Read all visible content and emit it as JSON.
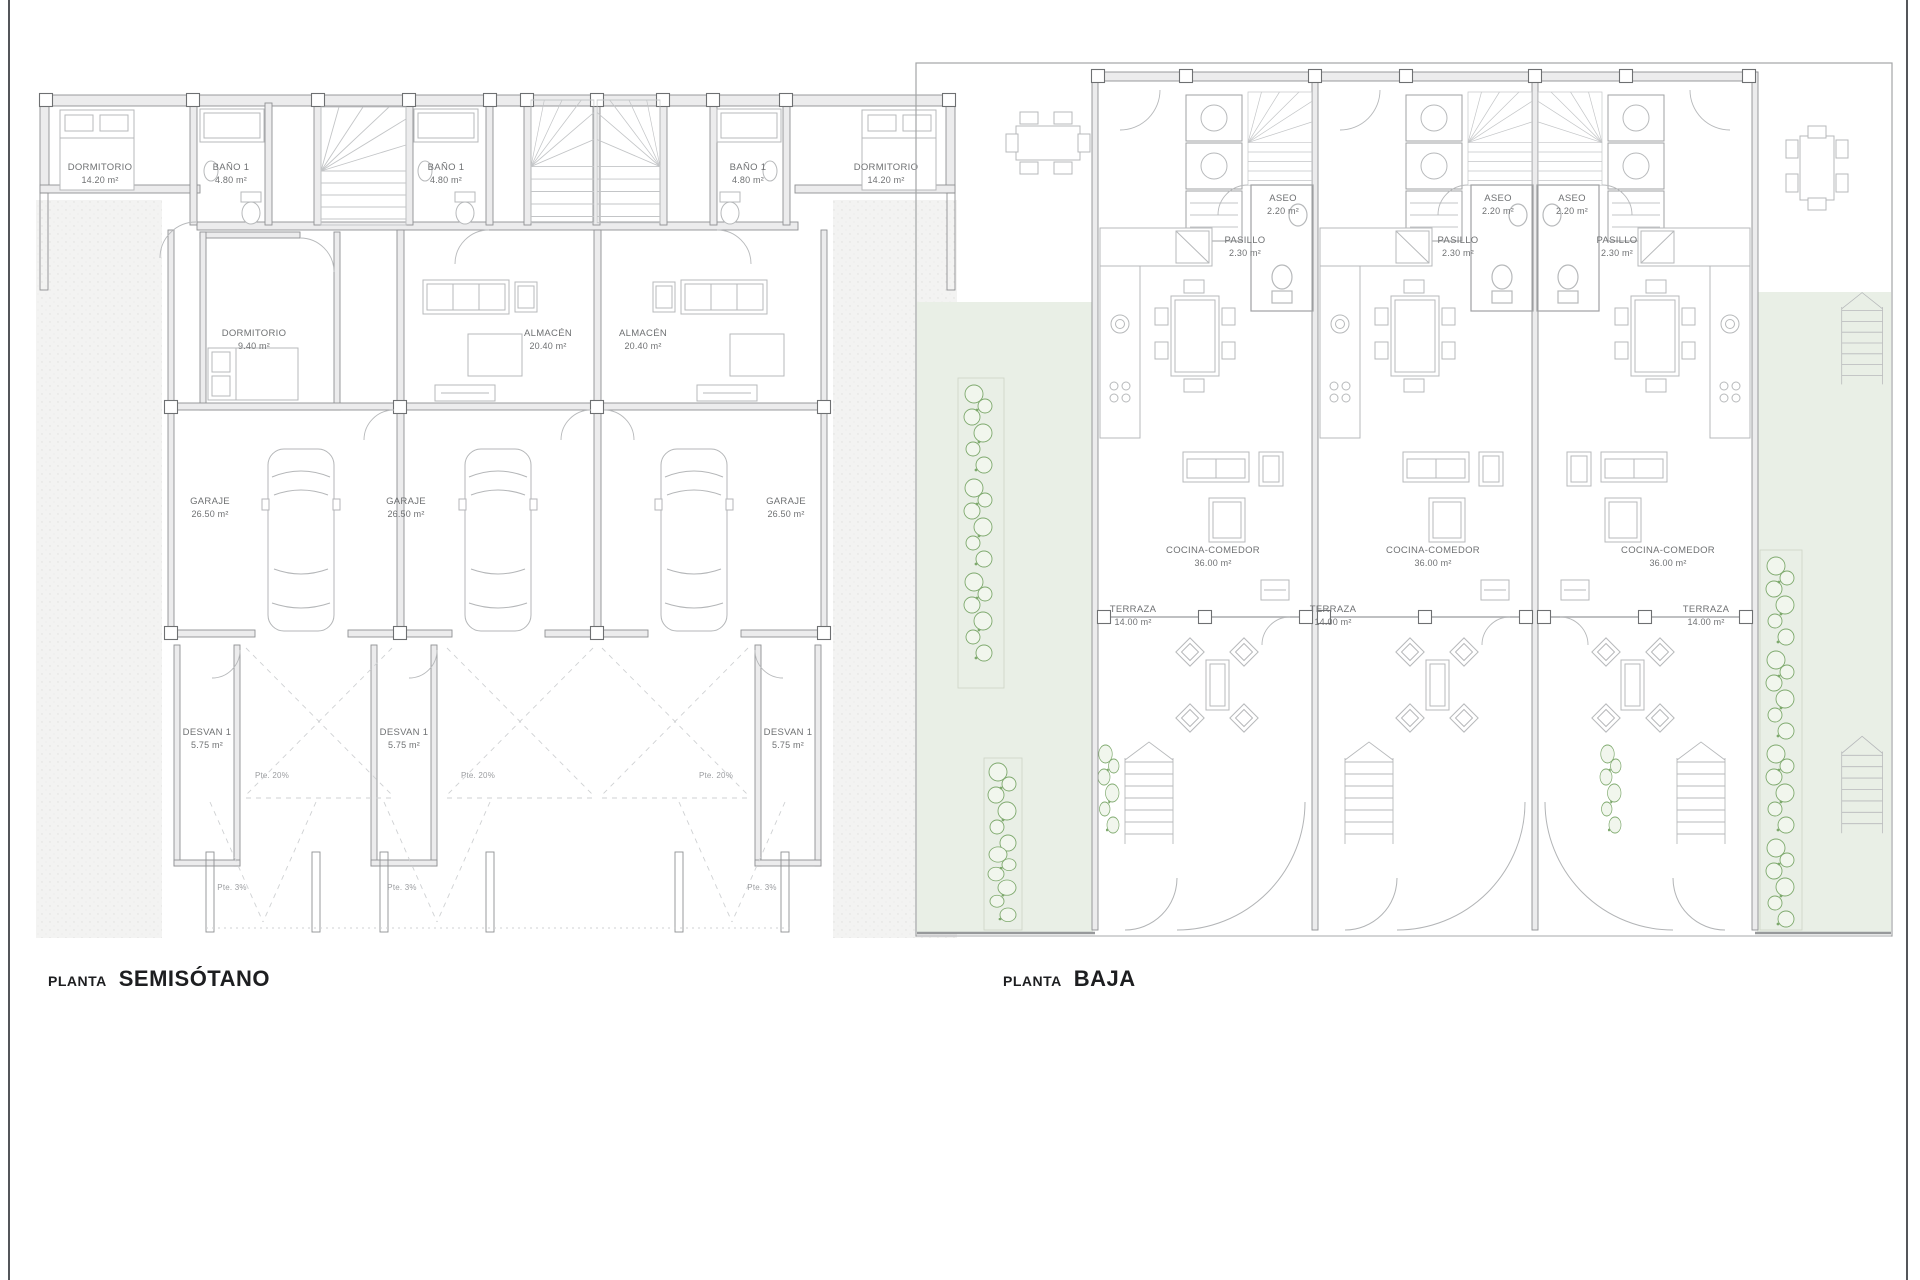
{
  "sheet": {
    "type": "architectural floor plan sheet",
    "background_color": "#ffffff",
    "border_color": "#54565a"
  },
  "palette": {
    "wall_line": "#8f9193",
    "wall_fill": "#ececed",
    "fixture_line": "#b7b9bb",
    "stair_line": "#c3c5c7",
    "label_text": "#6f7173",
    "title_text": "#1d1e20",
    "garden_fill": "#e9efe6",
    "plant_line": "#7ea96d",
    "terrain_dot": "#e0e0de"
  },
  "plans": {
    "semisotano": {
      "title_prefix": "PLANTA",
      "title_name": "SEMISÓTANO",
      "rooms": {
        "dormitorio_grande": {
          "name": "DORMITORIO",
          "area": "14.20 m²"
        },
        "bano": {
          "name": "BAÑO 1",
          "area": "4.80 m²"
        },
        "dormitorio_pequeno": {
          "name": "DORMITORIO",
          "area": "9.40 m²"
        },
        "almacen": {
          "name": "ALMACÉN",
          "area": "20.40 m²"
        },
        "garaje": {
          "name": "GARAJE",
          "area": "26.50 m²"
        },
        "desvan": {
          "name": "DESVAN 1",
          "area": "5.75 m²"
        }
      },
      "annotations": {
        "slope_20": "Pte. 20%",
        "slope_3": "Pte. 3%"
      },
      "units_count": 3
    },
    "baja": {
      "title_prefix": "PLANTA",
      "title_name": "BAJA",
      "rooms": {
        "aseo": {
          "name": "ASEO",
          "area": "2.20 m²"
        },
        "pasillo": {
          "name": "PASILLO",
          "area": "2.30 m²"
        },
        "cocina_comedor": {
          "name": "COCINA-COMEDOR",
          "area": "36.00 m²"
        },
        "terraza": {
          "name": "TERRAZA",
          "area": "14.00 m²"
        }
      },
      "units_count": 3
    }
  }
}
